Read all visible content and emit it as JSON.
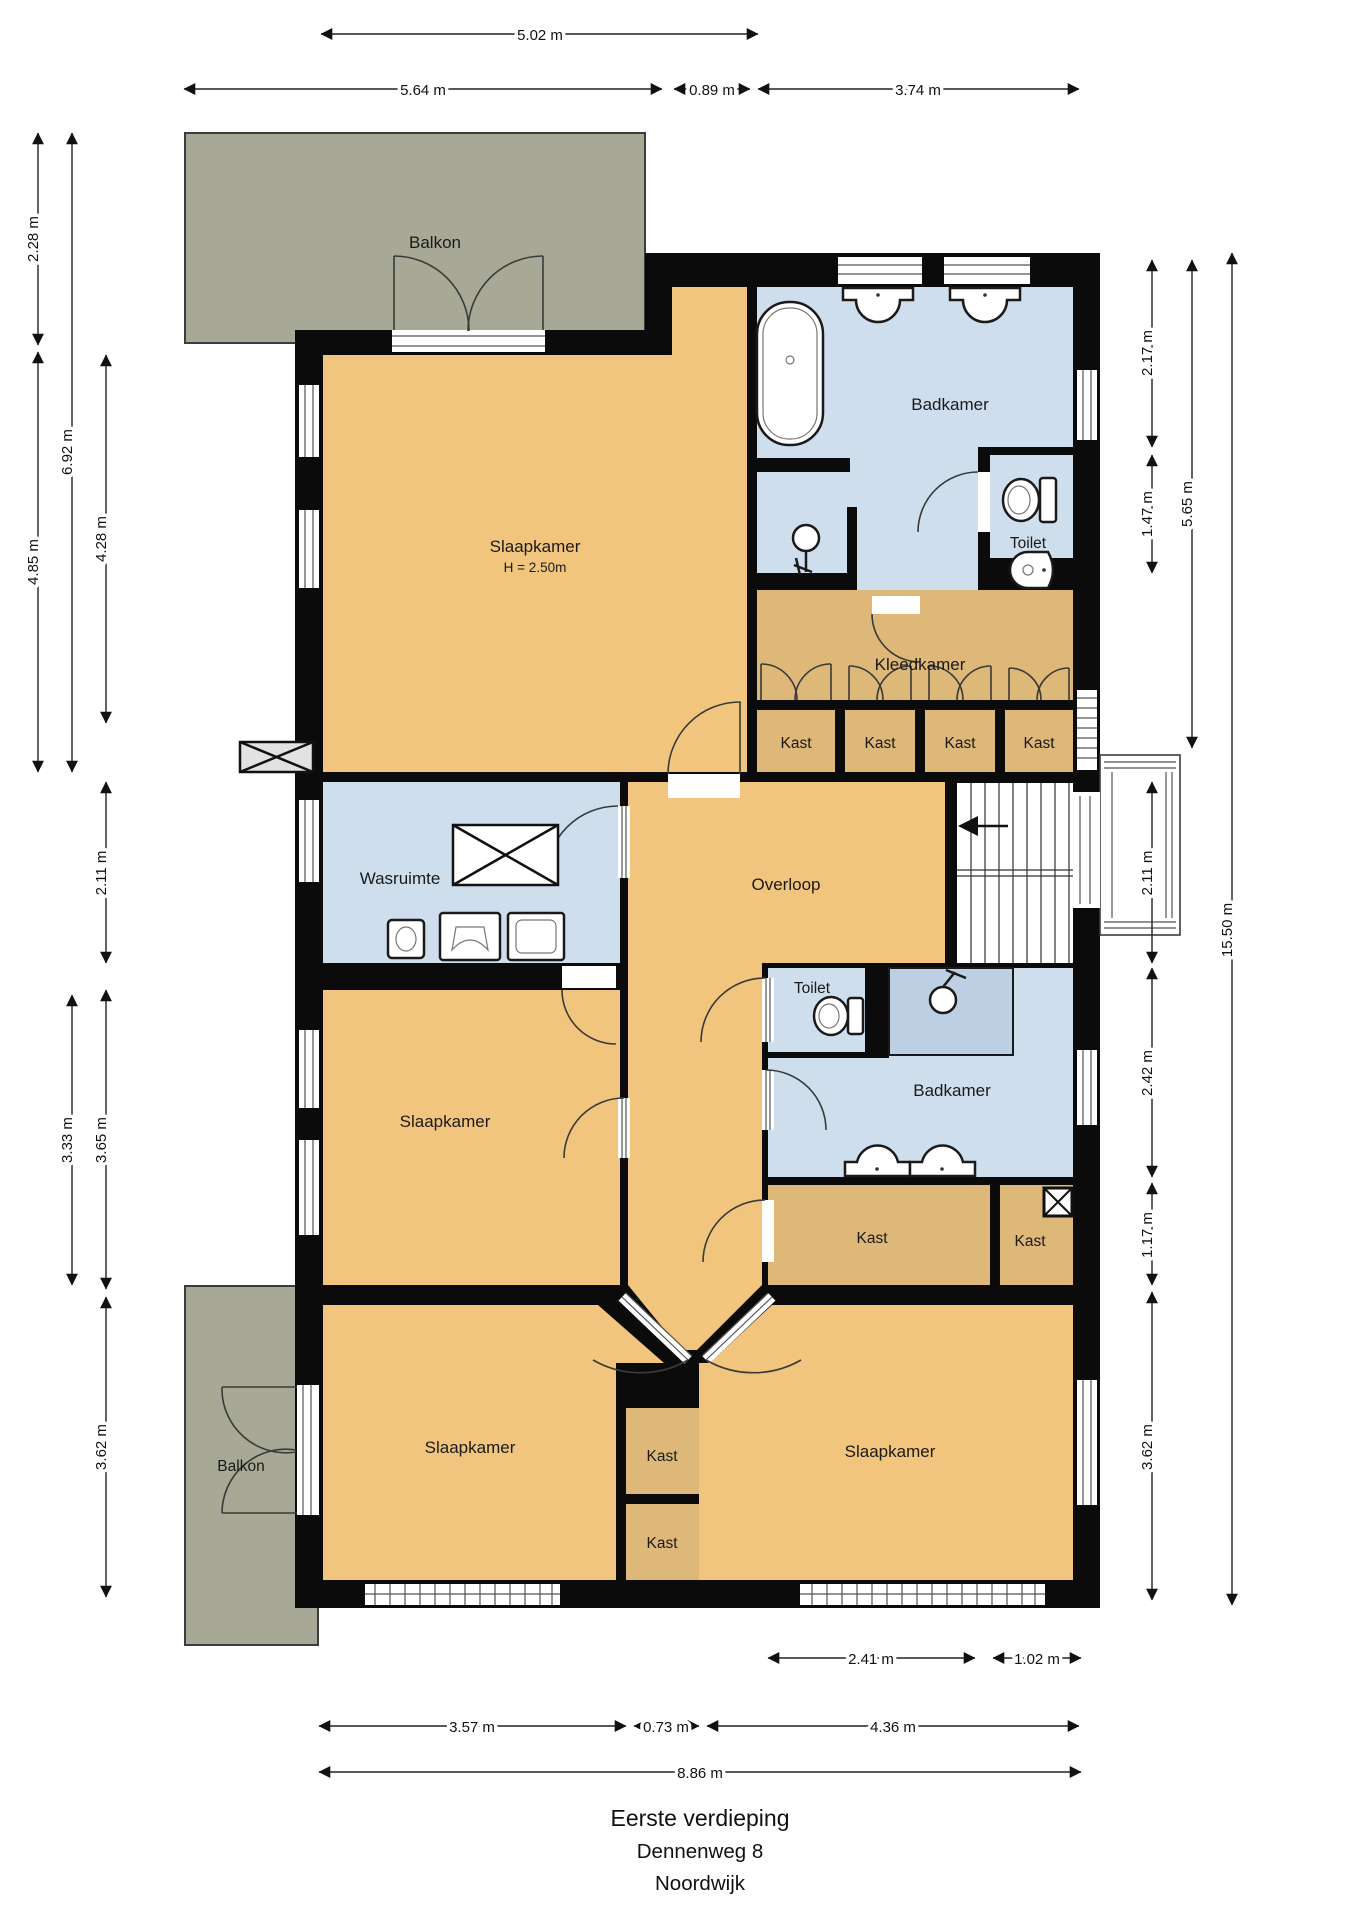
{
  "title": {
    "line1": "Eerste verdieping",
    "line2": "Dennenweg 8",
    "line3": "Noordwijk"
  },
  "rooms": {
    "balkon": "Balkon",
    "slaapkamer": "Slaapkamer",
    "slaapkamer_height": "H = 2.50m",
    "badkamer": "Badkamer",
    "toilet": "Toilet",
    "kleedkamer": "Kleedkamer",
    "kast": "Kast",
    "wasruimte": "Wasruimte",
    "overloop": "Overloop"
  },
  "dimensions": {
    "top": [
      "5.02 m",
      "5.64 m",
      "0.89 m",
      "3.74 m"
    ],
    "left": [
      "2.28 m",
      "6.92 m",
      "4.85 m",
      "4.28 m",
      "2.11 m",
      "3.33 m",
      "3.65 m",
      "3.62 m"
    ],
    "right": [
      "2.17 m",
      "1.47 m",
      "5.65 m",
      "2.11 m",
      "2.42 m",
      "1.17 m",
      "3.62 m",
      "15.50 m"
    ],
    "bottom": [
      "2.41 m",
      "1.02 m",
      "3.57 m",
      "0.73 m",
      "4.36 m",
      "8.86 m"
    ]
  },
  "colors": {
    "room_orange": "#F2C57E",
    "closet_tan": "#DEB878",
    "wet_blue": "#CFDEED",
    "shower_blue": "#BCCFE3",
    "balcony_grey": "#A7A896",
    "wall_black": "#0B0B0B"
  }
}
